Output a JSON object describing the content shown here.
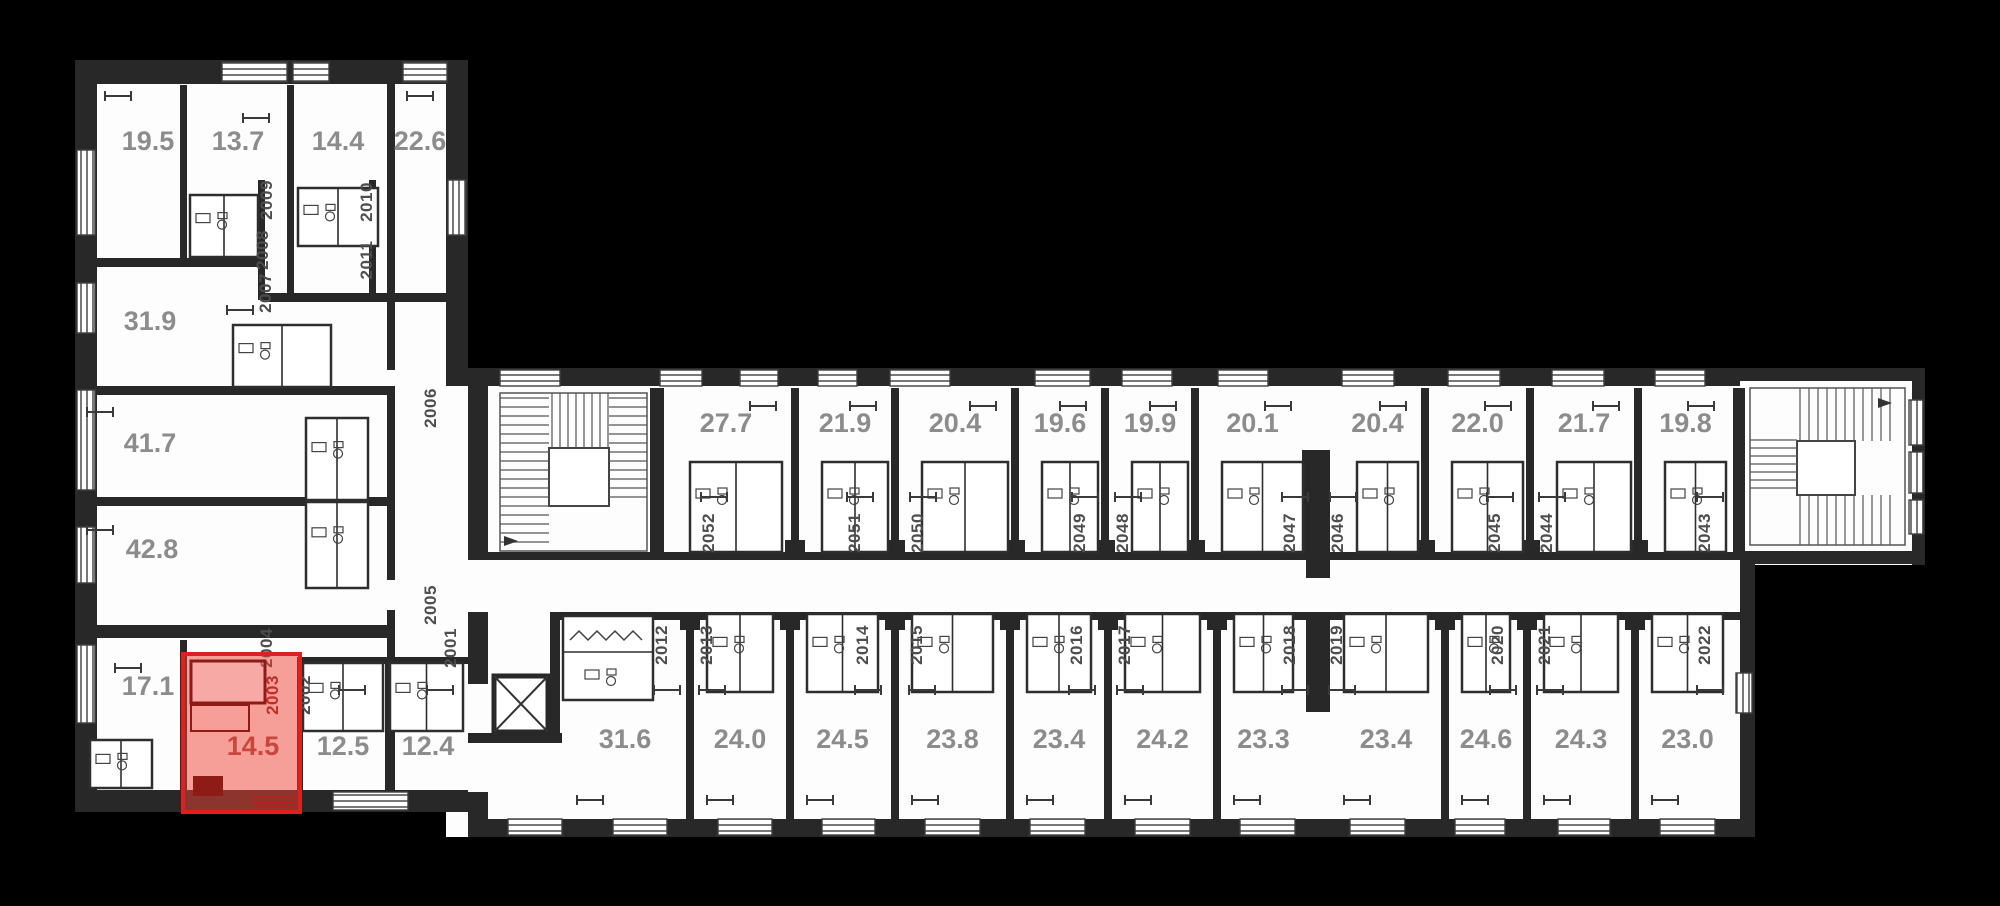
{
  "plan": {
    "type": "floor-plan",
    "colors": {
      "background": "#000000",
      "plan_fill": "#fdfdfd",
      "wall": "#282828",
      "area_label": "#8c8c8c",
      "unit_number": "#4d4d4d",
      "highlight_border": "#e01f1f",
      "highlight_fill": "#ef4136",
      "highlight_dark": "#8e1b16",
      "highlight_label": "#a34a43"
    },
    "highlighted_unit": {
      "unit": "2003",
      "area": "14.5"
    },
    "left_wing": {
      "area_labels": [
        "19.5",
        "13.7",
        "14.4",
        "22.6",
        "31.9",
        "41.7",
        "42.8",
        "17.1",
        "14.5",
        "12.5",
        "12.4"
      ],
      "unit_numbers": [
        "2001",
        "2002",
        "2003",
        "2004",
        "2005",
        "2006",
        "2007",
        "2008",
        "2009",
        "2010",
        "2011"
      ]
    },
    "main_wing": {
      "top_row": [
        {
          "unit": "2052",
          "area": "27.7"
        },
        {
          "unit": "2051",
          "area": "21.9"
        },
        {
          "unit": "2050",
          "area": "20.4"
        },
        {
          "unit": "2049",
          "area": "19.6"
        },
        {
          "unit": "2048",
          "area": "19.9"
        },
        {
          "unit": "2047",
          "area": "20.1"
        },
        {
          "unit": "2046",
          "area": "20.4"
        },
        {
          "unit": "2045",
          "area": "22.0"
        },
        {
          "unit": "2044",
          "area": "21.7"
        },
        {
          "unit": "2043",
          "area": "19.8"
        }
      ],
      "bottom_row": [
        {
          "unit": "2012",
          "area": "31.6"
        },
        {
          "unit": "2013",
          "area": "24.0"
        },
        {
          "unit": "2014",
          "area": "24.5"
        },
        {
          "unit": "2015",
          "area": "23.8"
        },
        {
          "unit": "2016",
          "area": "23.4"
        },
        {
          "unit": "2017",
          "area": "24.2"
        },
        {
          "unit": "2018",
          "area": "23.3"
        },
        {
          "unit": "2019",
          "area": "23.4"
        },
        {
          "unit": "2020",
          "area": "24.6"
        },
        {
          "unit": "2021",
          "area": "24.3"
        },
        {
          "unit": "2022",
          "area": "23.0"
        }
      ]
    }
  }
}
